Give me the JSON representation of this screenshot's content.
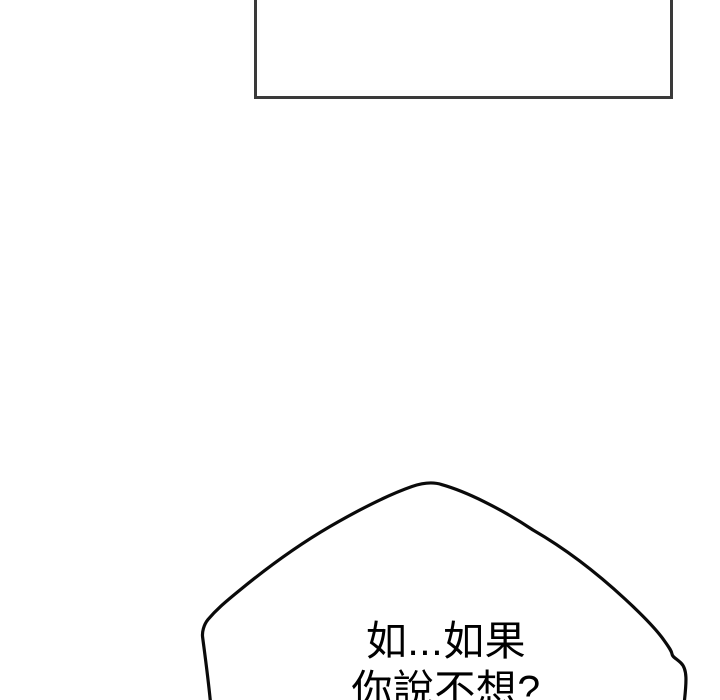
{
  "canvas": {
    "width": 720,
    "height": 700
  },
  "colors": {
    "paper": "#ffffff",
    "panel_border": "#3a3a3a",
    "bubble_outline": "#0a0a0a",
    "ink": "#000000"
  },
  "comic_panel": {
    "content": ""
  },
  "speech_bubble": {
    "lines": [
      "如...如果",
      "你說不想?"
    ]
  }
}
